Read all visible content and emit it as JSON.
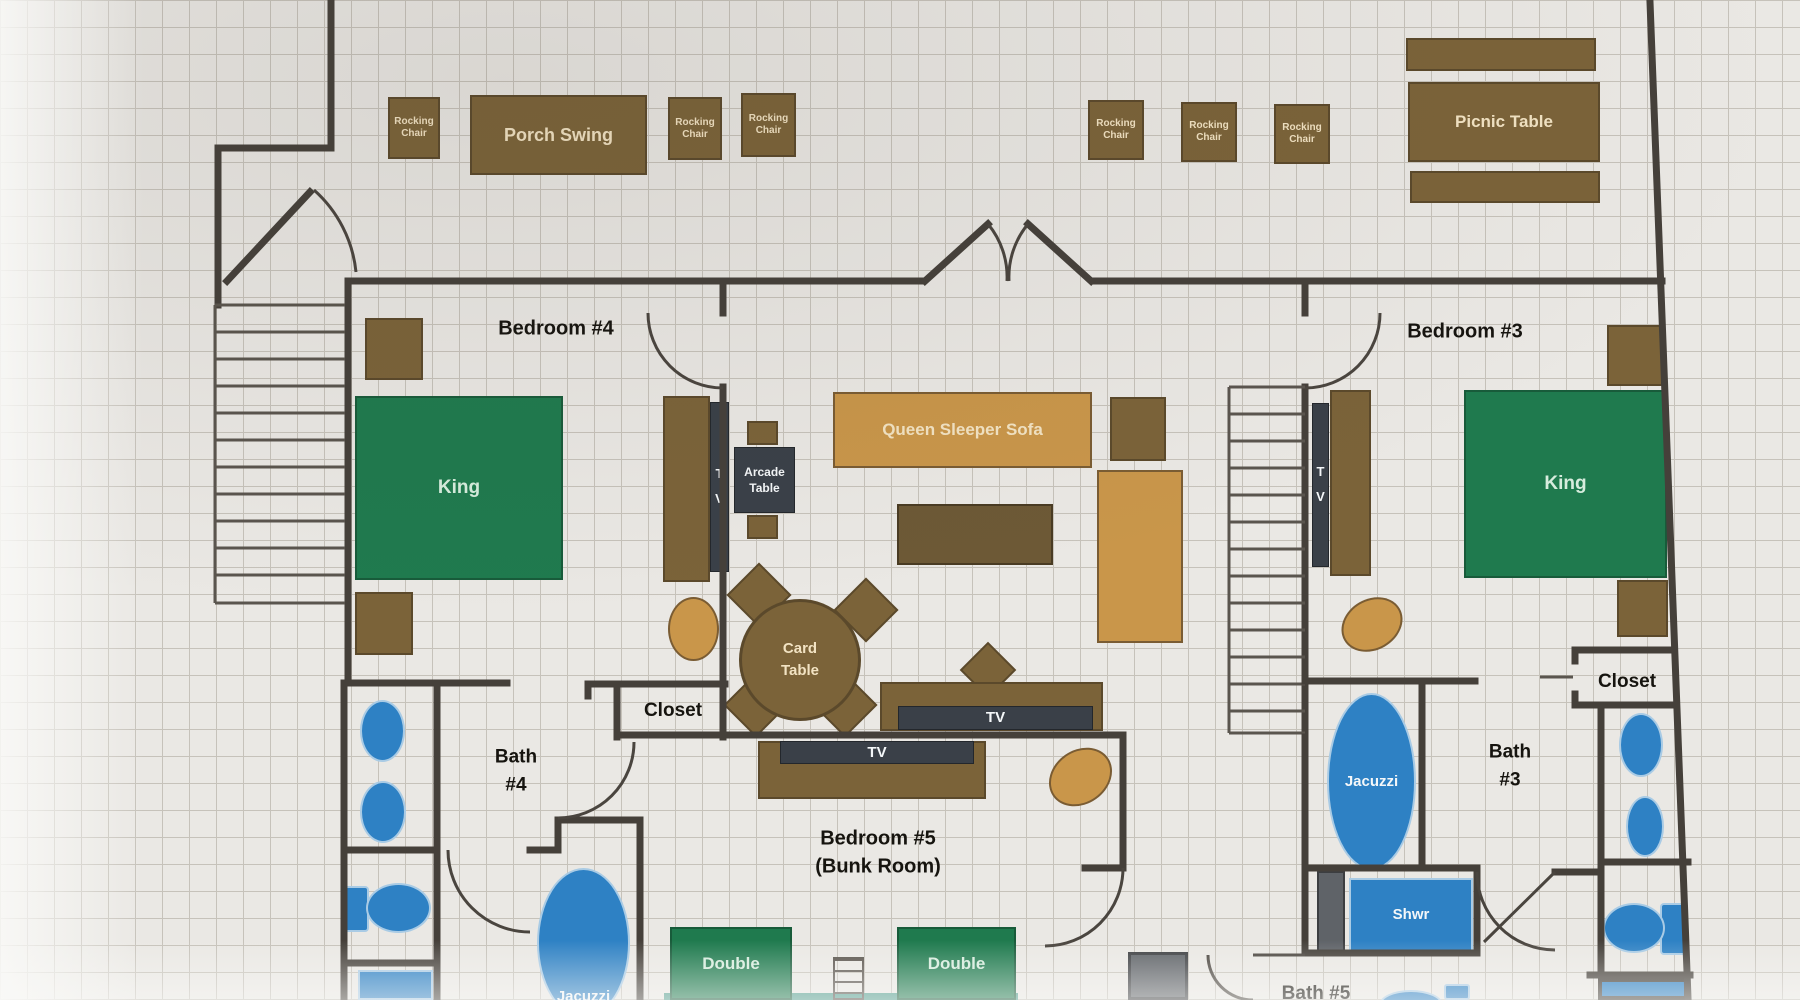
{
  "furniture": {
    "rocking_chair": "Rocking\nChair",
    "porch_swing": "Porch Swing",
    "picnic_table": "Picnic Table",
    "queen_sleeper_sofa": "Queen Sleeper Sofa",
    "arcade_table": "Arcade\nTable",
    "card_table": "Card\nTable",
    "tv": "TV",
    "tv_vertical": "T\nV",
    "king_bed": "King",
    "double_bed": "Double",
    "jacuzzi": "Jacuzzi",
    "shower": "Shwr"
  },
  "rooms": {
    "bedroom_4": "Bedroom #4",
    "bedroom_3": "Bedroom #3",
    "bedroom_5_title": "Bedroom #5",
    "bedroom_5_subtitle": "(Bunk Room)",
    "bath_4": "Bath\n#4",
    "bath_3": "Bath\n#3",
    "bath_5": "Bath #5",
    "closet": "Closet"
  },
  "colors": {
    "paper": "#eae8e4",
    "grid_line": "#c6c2ba",
    "wall": "#45403a",
    "wood_brown": "#7b6339",
    "wood_dark": "#6d5936",
    "tan": "#c9964a",
    "green": "#1f7a4e",
    "blue": "#2e81c4",
    "slate": "#3a4048",
    "gray_box": "#5f6368",
    "teal": "#4f9b8c",
    "cream_text": "#f2e3c3",
    "white_text": "#f4f7f9",
    "bed_text": "#d6ecdd",
    "room_text": "#16140f"
  }
}
